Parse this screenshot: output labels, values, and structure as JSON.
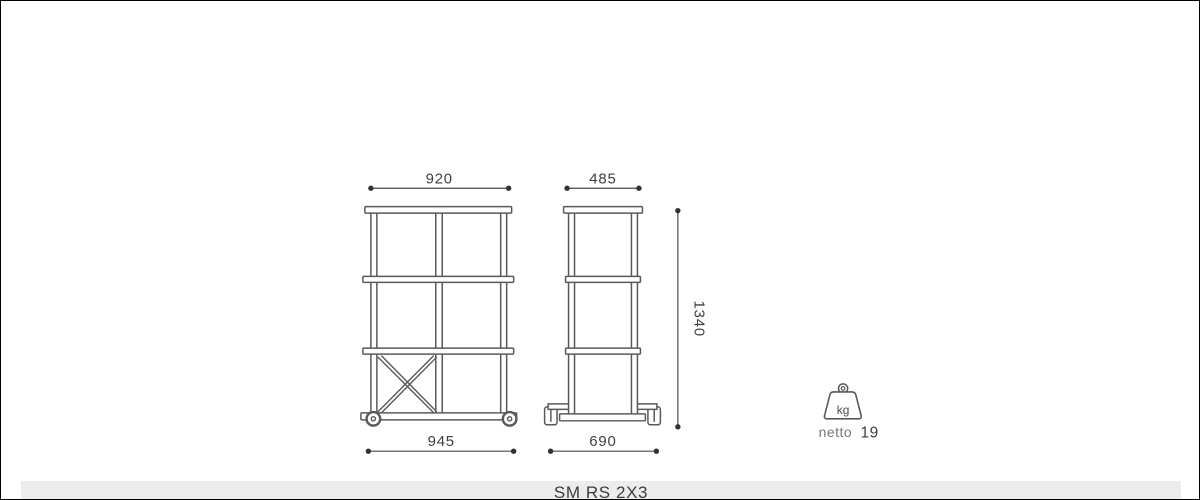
{
  "product": {
    "code": "SM RS 2X3"
  },
  "dimensions": {
    "front_width_top": "920",
    "front_width_bottom": "945",
    "side_depth_top": "485",
    "side_depth_bottom": "690",
    "height": "1340"
  },
  "weight": {
    "unit": "kg",
    "label": "netto",
    "value": "19"
  },
  "icons": {
    "weight_icon": "kettlebell-weight-with-ring"
  },
  "colors": {
    "drawing_line": "#58595b",
    "dimension_line": "#4a4a4a",
    "dimension_text": "#3d3f42",
    "muted_text": "#75777a",
    "footer_background": "#ececec",
    "page_border": "#000000",
    "background": "#ffffff"
  }
}
